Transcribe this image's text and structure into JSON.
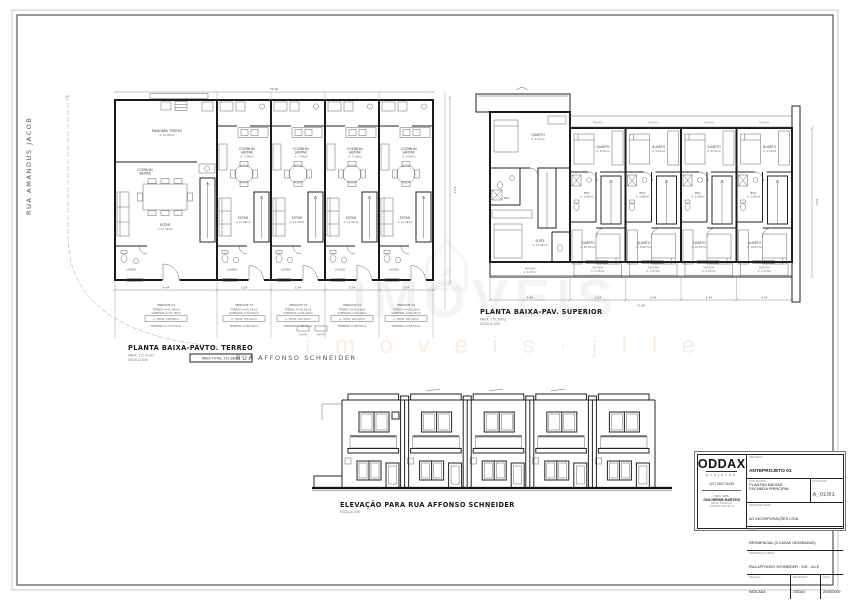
{
  "streets": {
    "left": "RUA AMANDUS JACOB",
    "bottom": "RUA AFFONSO SCHNEIDER"
  },
  "terreo": {
    "title": "PLANTA BAIXA-PAVTO. TERREO",
    "sub_area": "ÁREA: 171,41m2",
    "sub_scale": "ESCALA:1/50",
    "total_box": "ÁREA TOTAL 332,86m2",
    "dim_top": "34,00",
    "dim_side": "8,47",
    "dims_bottom": [
      "4,44",
      "3,54",
      "3,54",
      "3,54",
      "3,54"
    ],
    "gate1": "LIXEIRA",
    "gate2": "PORTÃO",
    "units": [
      {
        "name": "UNIDADE 01",
        "l1": "TÉRREO A=61,04m2",
        "l2": "SUPERIOR A=77,78m2",
        "total": "A. TOTAL 138,82m2",
        "terreno": "TERRENO A=176,70m2"
      },
      {
        "name": "UNIDADE 02",
        "l1": "TÉRREO A=52,16m2",
        "l2": "SUPERIOR A=53,26m2",
        "total": "A. TOTAL 105,42m2",
        "terreno": "TERRENO A=88,50m2"
      },
      {
        "name": "UNIDADE 03",
        "l1": "TÉRREO A=52,16m2",
        "l2": "SUPERIOR A=53,26m2",
        "total": "A. TOTAL 105,42m2",
        "terreno": "TERRENO A=88,50m2"
      },
      {
        "name": "UNIDADE 04",
        "l1": "TÉRREO A=52,16m2",
        "l2": "SUPERIOR A=53,26m2",
        "total": "A. TOTAL 105,42m2",
        "terreno": "TERRENO A=88,50m2"
      },
      {
        "name": "UNIDADE 05",
        "l1": "TÉRREO A=52,16m2",
        "l2": "SUPERIOR A=53,26m2",
        "total": "A. TOTAL 105,42m2",
        "terreno": "TERRENO A=88,50m2"
      }
    ]
  },
  "superior": {
    "title": "PLANTA BAIXA-PAV. SUPERIOR",
    "sub_area": "ÁREA: 175,56m2",
    "sub_scale": "ESCALA:1/50",
    "dims_bottom": [
      "4,44",
      "3,54",
      "3,54",
      "3,54",
      "3,54"
    ],
    "dim_total": "17,69",
    "dim_side": "8,47"
  },
  "elevacao": {
    "title": "ELEVAÇÃO PARA RUA AFFONSO SCHNEIDER",
    "sub_scale": "ESCALA:1/50"
  },
  "rooms": {
    "garagem": "MANOBRA TÉRREO",
    "garagem_area": "A: 31,04m2",
    "cozinha1": "COZINHA/",
    "cozinha2": "JANTAR",
    "cozinha_area": "A: 7,54m2",
    "estar": "ESTAR",
    "estar_area": "A: 11,34m2",
    "lavabo": "LAVABO",
    "quarto": "QUARTO",
    "quarto_area": "A: 9,11m2",
    "quarto2_area": "A: 10,87m2",
    "suite": "SUÍTE",
    "suite_area": "A: 11,45m2",
    "bwc": "BWC",
    "bwc_area": "A: 3,80m2",
    "sacada": "SACADA",
    "sacada_area": "A: 2,47m2",
    "telhado": "TELHADO"
  },
  "titleblock": {
    "logo": "ODDAX",
    "logo_sub": "projetos",
    "phone": "(47) 3027-6439",
    "arch1": "ARQ. URB.",
    "arch2": "GUILHERME MARTINS",
    "arch3": "RESP. TÉCNICO",
    "arch4": "CREA/SC 062.447-9",
    "f1_label": "PROJETO:",
    "f1_value": "ANTEPROJETO 01",
    "f2_label": "CONTEÚDO:",
    "f2_value1": "PLANTAS BAIXAS",
    "f2_value2": "FACHADA PRINCIPAL",
    "sheet_label": "PRANCHA:",
    "sheet_value": "A_01/01",
    "owner_label": "PROPRIETÁRIO:",
    "owner_value": "AG INCORPORAÇÕES LTDA",
    "obra_label": "OBRA:",
    "obra_value": "RESIDENCIAL (5 CASAS GEMINADAS)",
    "end_label": "ENDEREÇO OBRA:",
    "end_value": "RUA AFFONSO SCHNEIDER - S/N - JLLE",
    "escala_label": "ESCALA:",
    "escala_value": "INDICADA",
    "desenho_label": "DESENHO:",
    "desenho_value": "ODDAX",
    "data_label": "DATA:",
    "data_value": "26/05/2009"
  },
  "watermark": {
    "house": "⌂",
    "big": "IMÓVEIS",
    "small": "i m ó v e i s · j l l e"
  }
}
